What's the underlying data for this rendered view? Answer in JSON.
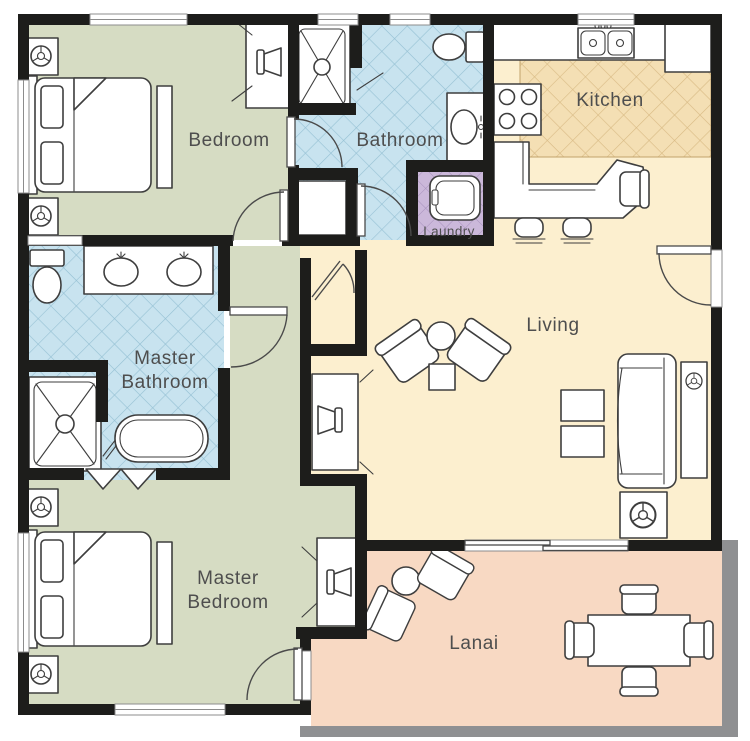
{
  "plan": {
    "type": "floorplan",
    "rooms": {
      "bedroom": {
        "label": "Bedroom"
      },
      "bathroom": {
        "label": "Bathroom"
      },
      "kitchen": {
        "label": "Kitchen"
      },
      "laundry": {
        "label": "Laundry"
      },
      "living": {
        "label": "Living"
      },
      "master_bathroom": {
        "line1": "Master",
        "line2": "Bathroom"
      },
      "master_bedroom": {
        "line1": "Master",
        "line2": "Bedroom"
      },
      "lanai": {
        "label": "Lanai"
      }
    },
    "palette": {
      "wall": "#1d1d1b",
      "lanai_wall": "#8f9092",
      "bedroom": "#d6dcc3",
      "bathroom": "#c8e3ef",
      "bathroom_line": "#96c1d4",
      "kitchen": "#f4dfb4",
      "kitchen_line": "#d8ba84",
      "laundry": "#cbb8da",
      "laundry_line": "#a791bd",
      "living": "#fcefcf",
      "lanai": "#f8d9c3",
      "stroke": "#3e3e3e",
      "label": "#4e4e4e"
    }
  }
}
